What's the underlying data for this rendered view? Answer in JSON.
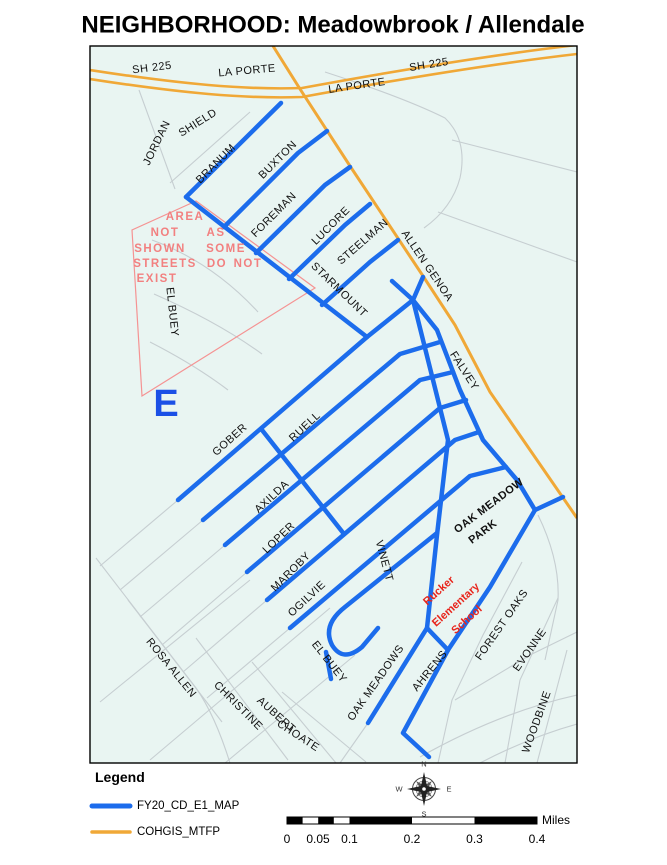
{
  "title": "NEIGHBORHOOD: Meadowbrook / Allendale",
  "colors": {
    "map_bg": "#e9f5f2",
    "blue": "#1c6cec",
    "orange": "#f0a837",
    "minor_street": "#c6ced1",
    "pink_outline": "#f59393",
    "label_black": "#111111",
    "warn_text": "#f28080",
    "school_red": "#e8251c",
    "big_e_blue": "#1b50e6",
    "border": "#000000"
  },
  "map": {
    "labels": [
      {
        "t": "SH 225",
        "x": 152,
        "y": 68,
        "r": -7,
        "c": "street"
      },
      {
        "t": "LA PORTE",
        "x": 247,
        "y": 71,
        "r": -5,
        "c": "street"
      },
      {
        "t": "LA PORTE",
        "x": 357,
        "y": 86,
        "r": -8,
        "c": "street"
      },
      {
        "t": "SH 225",
        "x": 429,
        "y": 65,
        "r": -9,
        "c": "street"
      },
      {
        "t": "JORDAN",
        "x": 157,
        "y": 143,
        "r": -64,
        "c": "street"
      },
      {
        "t": "SHIELD",
        "x": 198,
        "y": 123,
        "r": -32,
        "c": "street"
      },
      {
        "t": "BRANUM",
        "x": 216,
        "y": 164,
        "r": -45,
        "c": "street"
      },
      {
        "t": "BUXTON",
        "x": 278,
        "y": 160,
        "r": -45,
        "c": "street"
      },
      {
        "t": "FOREMAN",
        "x": 274,
        "y": 215,
        "r": -45,
        "c": "street"
      },
      {
        "t": "LUCORE",
        "x": 331,
        "y": 226,
        "r": -45,
        "c": "street"
      },
      {
        "t": "STEELMAN",
        "x": 363,
        "y": 242,
        "r": -41,
        "c": "street"
      },
      {
        "t": "STARMOUNT",
        "x": 339,
        "y": 290,
        "r": 44,
        "c": "street"
      },
      {
        "t": "ALLEN GENOA",
        "x": 427,
        "y": 266,
        "r": 56,
        "c": "street"
      },
      {
        "t": "FALVEY",
        "x": 464,
        "y": 371,
        "r": 57,
        "c": "street"
      },
      {
        "t": "EL BUEY",
        "x": 172,
        "y": 312,
        "r": 84,
        "c": "street"
      },
      {
        "t": "E",
        "x": 166,
        "y": 404,
        "r": 0,
        "c": "bigE"
      },
      {
        "t": "GOBER",
        "x": 230,
        "y": 440,
        "r": -42,
        "c": "street"
      },
      {
        "t": "RUELL",
        "x": 305,
        "y": 427,
        "r": -43,
        "c": "street"
      },
      {
        "t": "AXILDA",
        "x": 272,
        "y": 497,
        "r": -43,
        "c": "street"
      },
      {
        "t": "LOPER",
        "x": 279,
        "y": 538,
        "r": -44,
        "c": "street"
      },
      {
        "t": "MAROBY",
        "x": 291,
        "y": 572,
        "r": -45,
        "c": "street"
      },
      {
        "t": "OGILVIE",
        "x": 307,
        "y": 599,
        "r": -43,
        "c": "street"
      },
      {
        "t": "VINETT",
        "x": 384,
        "y": 561,
        "r": 75,
        "c": "street"
      },
      {
        "t": "EL BUEY",
        "x": 329,
        "y": 662,
        "r": 52,
        "c": "street"
      },
      {
        "t": "OAK MEADOWS",
        "x": 376,
        "y": 683,
        "r": -55,
        "c": "street"
      },
      {
        "t": "AHRENS",
        "x": 430,
        "y": 671,
        "r": -51,
        "c": "street"
      },
      {
        "t": "FOREST OAKS",
        "x": 502,
        "y": 625,
        "r": -55,
        "c": "street"
      },
      {
        "t": "EVONNE",
        "x": 530,
        "y": 650,
        "r": -55,
        "c": "street"
      },
      {
        "t": "WOODBINE",
        "x": 537,
        "y": 722,
        "r": -70,
        "c": "street"
      },
      {
        "t": "ROSA ALLEN",
        "x": 171,
        "y": 668,
        "r": 51,
        "c": "street"
      },
      {
        "t": "CHRISTINE",
        "x": 238,
        "y": 706,
        "r": 45,
        "c": "street"
      },
      {
        "t": "AUBERT",
        "x": 276,
        "y": 715,
        "r": 42,
        "c": "street"
      },
      {
        "t": "CHOATE",
        "x": 298,
        "y": 736,
        "r": 33,
        "c": "street"
      },
      {
        "t": "OAK MEADOW",
        "x": 489,
        "y": 506,
        "r": -37,
        "c": "park"
      },
      {
        "t": "PARK",
        "x": 483,
        "y": 532,
        "r": -37,
        "c": "park"
      },
      {
        "t": "Rucker",
        "x": 439,
        "y": 591,
        "r": -42,
        "c": "school"
      },
      {
        "t": "Elementary",
        "x": 456,
        "y": 605,
        "r": -42,
        "c": "school"
      },
      {
        "t": "School",
        "x": 467,
        "y": 620,
        "r": -42,
        "c": "school"
      },
      {
        "t": "AREA",
        "x": 185,
        "y": 217,
        "r": 0,
        "c": "warn"
      },
      {
        "t": "NOT",
        "x": 165,
        "y": 233,
        "r": 0,
        "c": "warn"
      },
      {
        "t": "AS",
        "x": 216,
        "y": 233,
        "r": 0,
        "c": "warn"
      },
      {
        "t": "SHOWN",
        "x": 160,
        "y": 249,
        "r": 0,
        "c": "warn"
      },
      {
        "t": "SOME",
        "x": 226,
        "y": 249,
        "r": 0,
        "c": "warn"
      },
      {
        "t": "STREETS",
        "x": 165,
        "y": 264,
        "r": 0,
        "c": "warn"
      },
      {
        "t": "DO",
        "x": 217,
        "y": 264,
        "r": 0,
        "c": "warn"
      },
      {
        "t": "NOT",
        "x": 248,
        "y": 264,
        "r": 0,
        "c": "warn"
      },
      {
        "t": "EXIST",
        "x": 157,
        "y": 279,
        "r": 0,
        "c": "warn"
      }
    ]
  },
  "legend": {
    "heading": "Legend",
    "items": [
      {
        "label": "FY20_CD_E1_MAP",
        "color": "#1c6cec",
        "width": 5
      },
      {
        "label": "COHGIS_MTFP",
        "color": "#f0a837",
        "width": 3.5
      }
    ]
  },
  "scalebar": {
    "unit": "Miles",
    "ticks": [
      {
        "t": "0",
        "x": 287
      },
      {
        "t": "0.05",
        "x": 318
      },
      {
        "t": "0.1",
        "x": 349.5
      },
      {
        "t": "0.2",
        "x": 412
      },
      {
        "t": "0.3",
        "x": 474.5
      },
      {
        "t": "0.4",
        "x": 537
      }
    ]
  },
  "compass": {
    "points": [
      {
        "t": "N",
        "x": 424,
        "y": 764
      },
      {
        "t": "E",
        "x": 449,
        "y": 789
      },
      {
        "t": "S",
        "x": 424,
        "y": 814
      },
      {
        "t": "W",
        "x": 399,
        "y": 789
      }
    ]
  }
}
